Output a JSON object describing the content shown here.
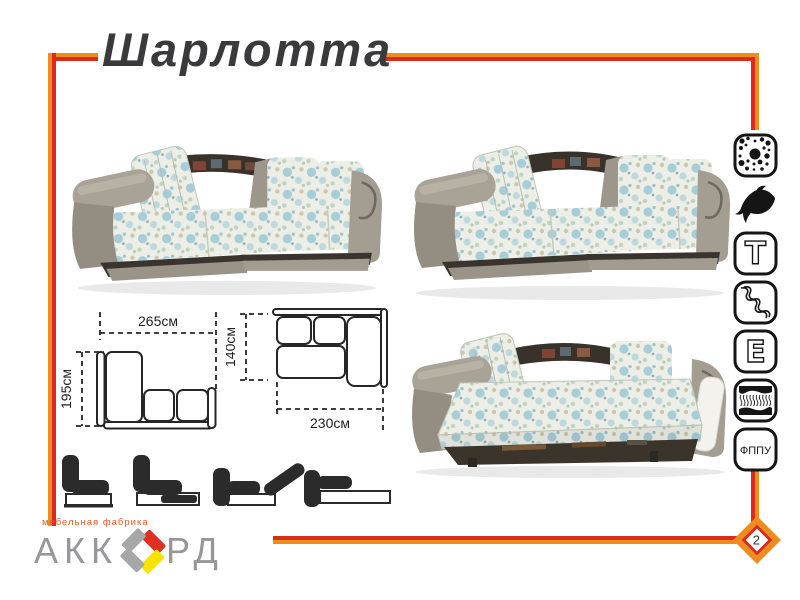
{
  "page": {
    "title": "Шарлотта",
    "page_number": "2"
  },
  "brand_colors": {
    "frame_orange": "#EE8C1E",
    "frame_red": "#DA2B1E",
    "title_text": "#3A3A3C",
    "logo_gray": "#97979B",
    "logo_red": "#E03024",
    "logo_yellow": "#F6E300"
  },
  "diagrams": {
    "folded": {
      "width": "265см",
      "depth": "195см"
    },
    "unfolded": {
      "width": "230см",
      "depth": "140см"
    }
  },
  "feature_icons": [
    {
      "name": "filling-dots-icon",
      "label": ""
    },
    {
      "name": "dolphin-mechanism-icon",
      "label": ""
    },
    {
      "name": "t-symbol-icon",
      "label": "Т"
    },
    {
      "name": "spring-snake-icon",
      "label": ""
    },
    {
      "name": "e-symbol-icon",
      "label": "Е"
    },
    {
      "name": "mattress-layers-icon",
      "label": ""
    },
    {
      "name": "fppu-icon",
      "label": "ФППУ"
    }
  ],
  "logo": {
    "subtitle": "мебельная фабрика",
    "wordmark_left": "АКК",
    "wordmark_right": "РД"
  }
}
